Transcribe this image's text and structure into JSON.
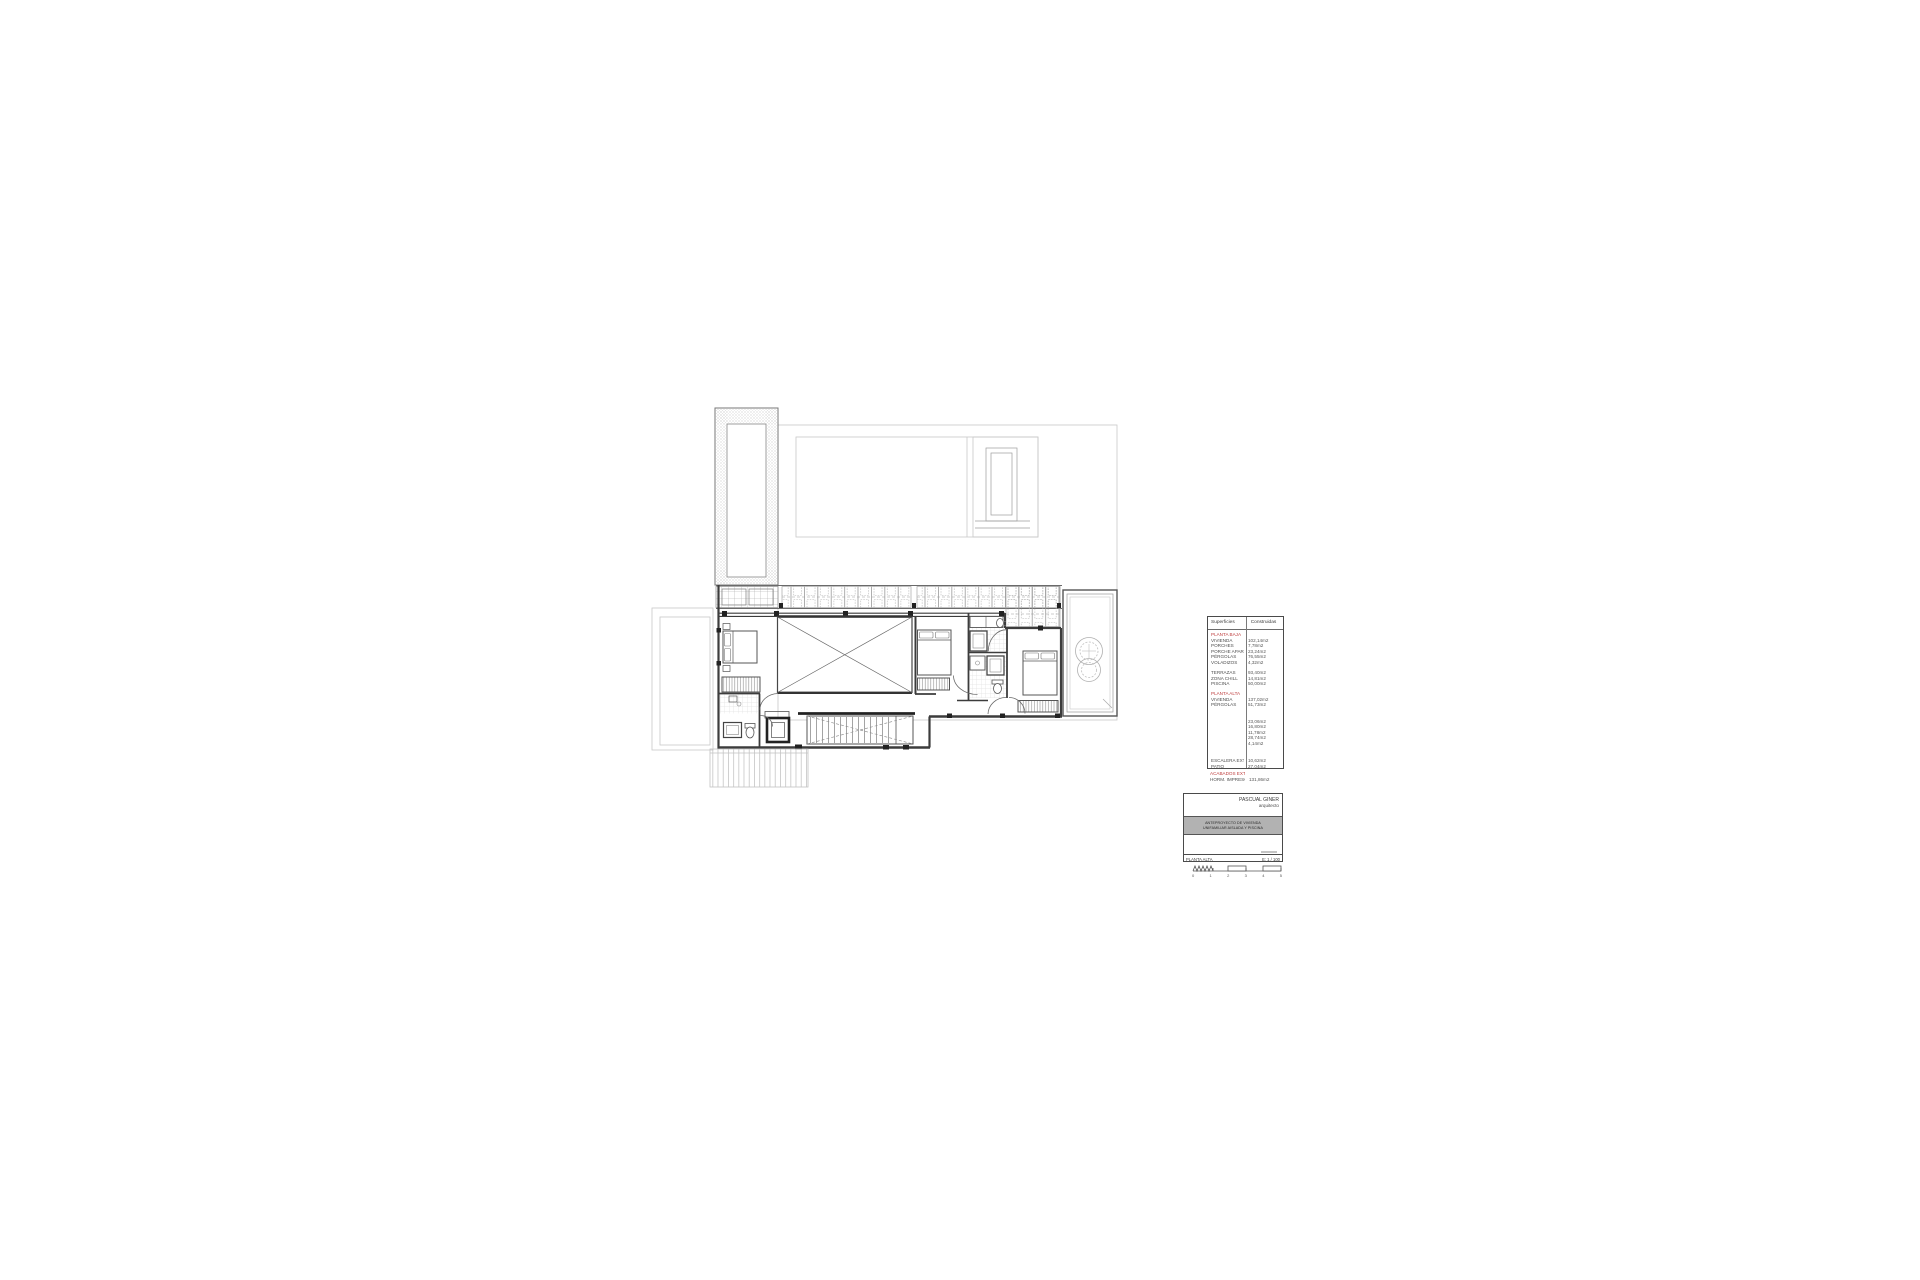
{
  "colors": {
    "accent_red": "#bf3f3f",
    "wall_dark": "#3c3c3c",
    "line_light": "#c8c8c8"
  },
  "areas_table": {
    "header": {
      "left": "Superficies",
      "right": "Construidas"
    },
    "rows": [
      {
        "type": "section",
        "label": "PLANTA BAJA"
      },
      {
        "type": "item",
        "label": "VIVIENDA",
        "value": "102,14m2"
      },
      {
        "type": "item",
        "label": "PORCHES",
        "value": "7,78m2"
      },
      {
        "type": "item",
        "label": "PORCHE APARC.",
        "value": "23,24m2"
      },
      {
        "type": "item",
        "label": "PÉRGOLAS",
        "value": "76,55m2"
      },
      {
        "type": "item",
        "label": "VOLADIZOS",
        "value": "4,32m2"
      },
      {
        "type": "spacer",
        "h": 5
      },
      {
        "type": "item",
        "label": "TERRAZAS",
        "value": "93,40m2"
      },
      {
        "type": "item",
        "label": "ZONA CHILL",
        "value": "14,81m2"
      },
      {
        "type": "item",
        "label": "PISCINA",
        "value": "50,00m2"
      },
      {
        "type": "spacer",
        "h": 4.5
      },
      {
        "type": "section",
        "label": "PLANTA ALTA"
      },
      {
        "type": "item",
        "label": "VIVIENDA",
        "value": "137,02m2"
      },
      {
        "type": "item",
        "label": "PÉRGOLAS",
        "value": "51,73m2"
      },
      {
        "type": "spacer",
        "h": 11
      },
      {
        "type": "item",
        "label": "",
        "value": "23,06m2"
      },
      {
        "type": "item",
        "label": "",
        "value": "16,80m2"
      },
      {
        "type": "item",
        "label": "",
        "value": "11,78m2"
      },
      {
        "type": "item",
        "label": "",
        "value": "28,74m2"
      },
      {
        "type": "item",
        "label": "",
        "value": "4,14m2"
      },
      {
        "type": "spacer",
        "h": 12
      },
      {
        "type": "item",
        "label": "ESCALERA EXT.",
        "value": "10,62m2"
      },
      {
        "type": "item",
        "label": "PATIO",
        "value": "27,04m2"
      }
    ],
    "footer": [
      {
        "type": "section",
        "label": "ACABADOS EXT."
      },
      {
        "type": "item",
        "label": "HORM. IMPRESO",
        "value": "131,86m2"
      }
    ]
  },
  "title_block": {
    "architect": "PASCUAL GINER",
    "architect_role": "arquitecto",
    "project_line1": "ANTEPROYECTO DE VIVIENDA",
    "project_line2": "UNIFAMILIAR AISLADA Y PISCINA",
    "sheet": "PLANTA ALTA",
    "scale": "E: 1 / 100"
  },
  "scale_bar": {
    "labels": [
      "0",
      "1",
      "2",
      "3",
      "4",
      "5"
    ]
  }
}
